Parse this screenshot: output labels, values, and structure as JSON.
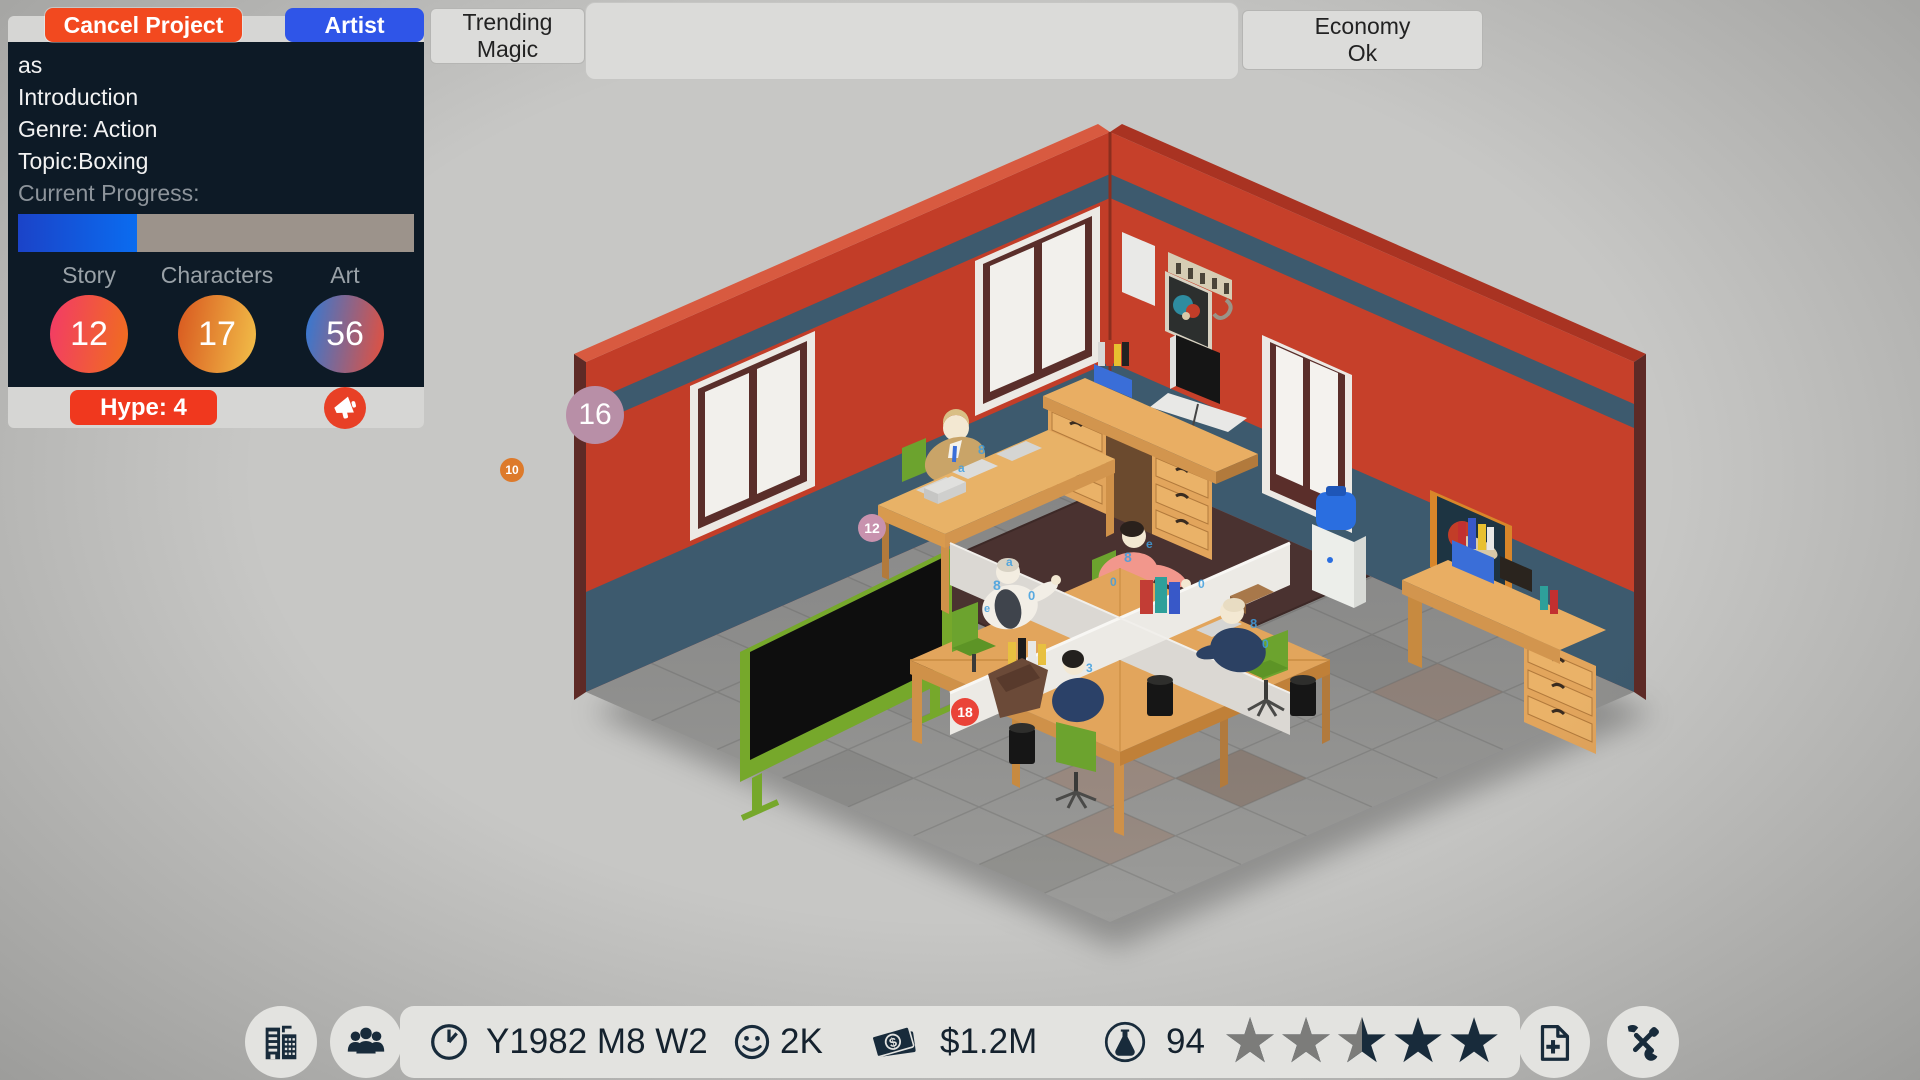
{
  "project_panel": {
    "cancel_button_label": "Cancel Project",
    "artist_button_label": "Artist",
    "project_name": "as",
    "project_line2": "Introduction",
    "genre_line": "Genre: Action",
    "topic_line": "Topic:Boxing",
    "progress_label": "Current Progress:",
    "progress_percent": 30,
    "progress_color_left": "#1b43c8",
    "progress_color_right": "#0a6cf0",
    "progress_track_color": "#9c938b",
    "stats": [
      {
        "label": "Story",
        "value": "12",
        "gradient": [
          "#f23a68",
          "#f06f1c"
        ]
      },
      {
        "label": "Characters",
        "value": "17",
        "gradient": [
          "#d8571f",
          "#f2c049"
        ]
      },
      {
        "label": "Art",
        "value": "56",
        "gradient": [
          "#2f7ad8",
          "#e84f3a"
        ]
      }
    ],
    "hype_button_label": "Hype: 4",
    "hype_button_color": "#f0381e",
    "megaphone_color": "#e84026"
  },
  "top_bar": {
    "trending_button": {
      "line1": "Trending",
      "line2": "Magic"
    },
    "info_box_value": "",
    "economy_button": {
      "line1": "Economy",
      "line2": "Ok"
    }
  },
  "scene": {
    "badges": [
      {
        "value": "16",
        "color": "#b88fa7"
      },
      {
        "value": "10",
        "color": "#dd7a2b"
      },
      {
        "value": "12",
        "color": "#c892ae"
      },
      {
        "value": "18",
        "color": "#ea4338"
      }
    ]
  },
  "bottom_bar": {
    "date_text": "Y1982 M8 W2",
    "fans_value": "2K",
    "money_value": "$1.2M",
    "research_value": "94",
    "rating": {
      "stars_total": 5,
      "stars_gray": 2.5,
      "gray_color": "#7c7c7a",
      "filled_color": "#182b3b"
    },
    "icon_color": "#182b3b"
  }
}
